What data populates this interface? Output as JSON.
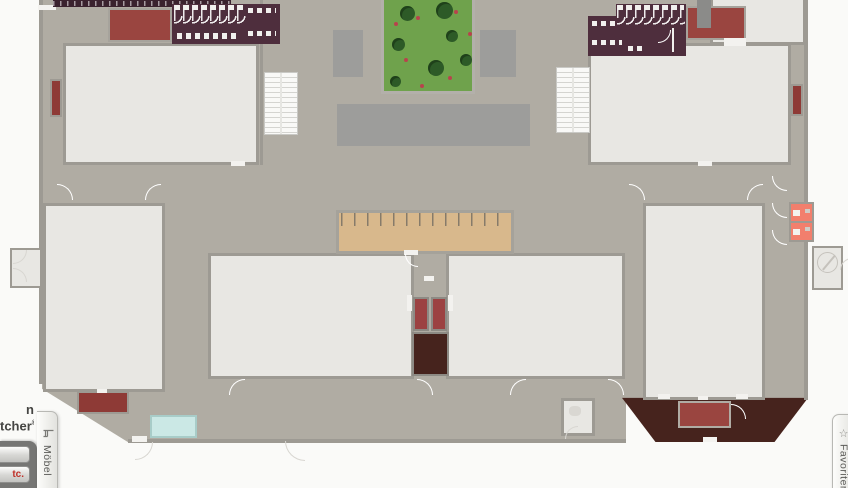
{
  "ui": {
    "logo": {
      "line1_fragment": "n",
      "line2_fragment": "tcher",
      "registered_mark": "®"
    },
    "left_panel": {
      "buttons": [
        {
          "label": ""
        },
        {
          "label": "tc."
        }
      ]
    },
    "furniture_tab": {
      "label": "Möbel",
      "icon": "chair-icon"
    },
    "favorites_tab": {
      "label": "Favoriten",
      "icon": "star-icon",
      "star_glyph": "☆"
    }
  },
  "icons": {
    "furniture": "chair-icon",
    "favorites": "star-icon",
    "spiral_stairs": "spiral-stairs-icon"
  },
  "palette": {
    "canvas": "#fafaf8",
    "floor-common": "#b0aca3",
    "floor-room": "#e8e7e3",
    "wall": "#9d9a93",
    "slab": "#9d9d9b",
    "grass": "#6fa24c",
    "tree": "#2d5a27",
    "flower": "#b8434c",
    "restroom": "#4e2e3d",
    "red-area": "#9a4540",
    "table-red": "#8e3a36",
    "dark-brown": "#46231d",
    "salmon": "#f27f6d",
    "cyan": "#cbe8e5",
    "tan-counter": "#d8b88c",
    "button-text-red": "#c03028"
  }
}
